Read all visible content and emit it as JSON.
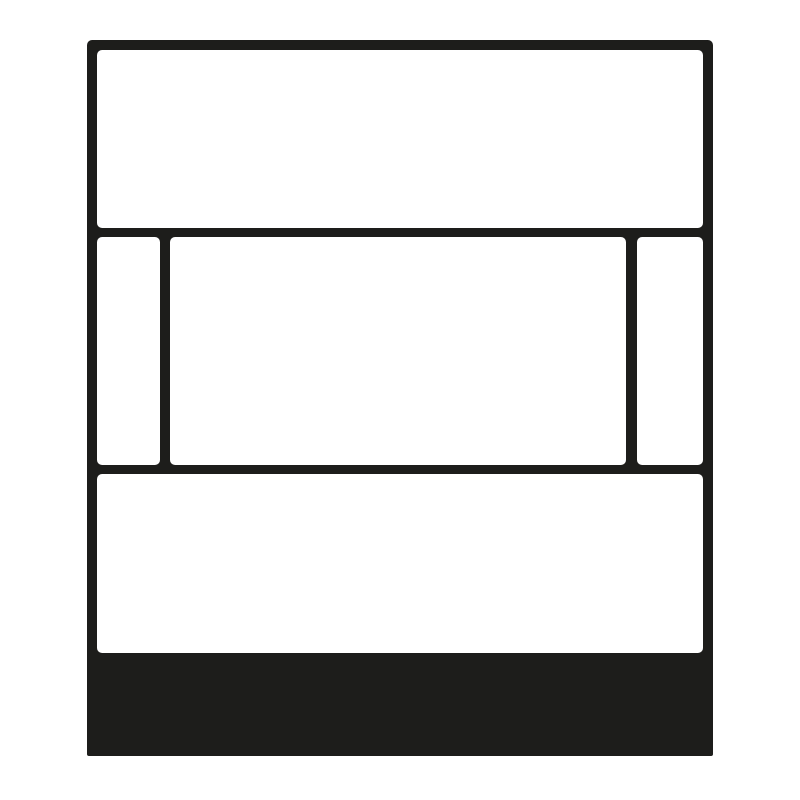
{
  "figure": {
    "description": "Black line-art front view of a rectangular wall-mounted device plate: blank top panel, middle row with narrow left slot, wide center window and narrow right slot, blank lower panel, and a solid black base strip at the bottom",
    "regions": {
      "plate": "outer device plate outline",
      "top_panel": "upper blank panel",
      "middle_left_slot": "narrow left window of middle row",
      "middle_center_window": "wide center window of middle row",
      "middle_right_slot": "narrow right window of middle row",
      "bottom_panel": "lower blank panel",
      "base_strip": "solid black base strip"
    }
  },
  "colors": {
    "ink": "#1d1d1b",
    "paper": "#ffffff",
    "background": "#ffffff"
  }
}
